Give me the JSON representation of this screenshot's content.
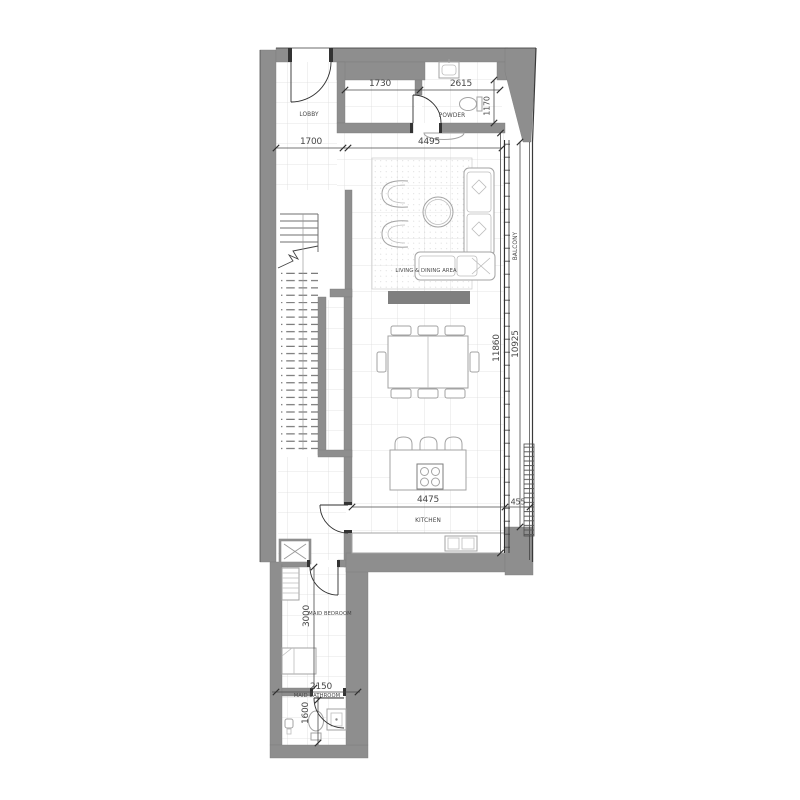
{
  "plan": {
    "sheet_title": "apartment-unit-floor-plan",
    "rooms": {
      "lobby": "LOBBY",
      "powder": "POWDER",
      "living_dining": "LIVING & DINING AREA",
      "balcony": "BALCONY",
      "kitchen": "KITCHEN",
      "maid_bedroom": "MAID BEDROOM",
      "maid_bathroom": "MAID BATHROOM"
    },
    "dimensions_mm": {
      "entry_hall_width": "1730",
      "powder_width": "2615",
      "powder_depth": "1170",
      "lobby_width": "1700",
      "living_width": "4495",
      "interior_length": "11860",
      "balcony_length": "10925",
      "kitchen_width": "4475",
      "balcony_depth": "455",
      "maid_bedroom_length": "3000",
      "maid_bathroom_width": "2150",
      "maid_bathroom_depth": "1600"
    },
    "colors": {
      "wall": "#8e8e8e",
      "line": "#3c3c3c",
      "furniture": "#a3a3a3",
      "grid": "#dcdcdc",
      "text": "#474747",
      "tv": "#7f7f7f",
      "bg": "#ffffff"
    }
  }
}
